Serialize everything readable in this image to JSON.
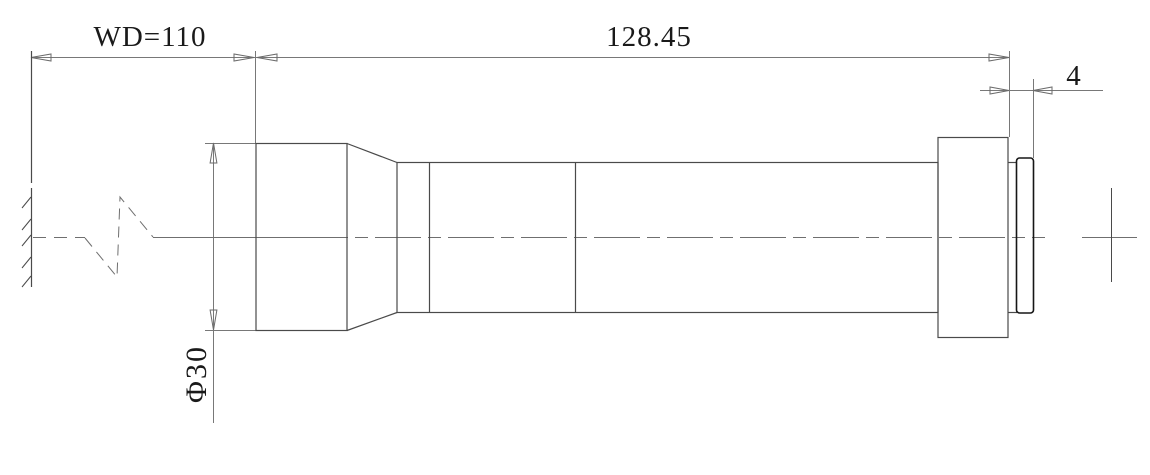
{
  "drawing": {
    "type": "technical-lens-drawing",
    "background": "#ffffff",
    "colors": {
      "object_line": "#4a4a4a",
      "dimension_line": "#787878",
      "centerline": "#6f6f6f",
      "ring_line": "#161616",
      "text": "#1a1a1a"
    },
    "dimensions": {
      "working_distance": {
        "label": "WD=110",
        "value": 110
      },
      "barrel_length": {
        "label": "128.45",
        "value": 128.45
      },
      "back_offset": {
        "label": "4",
        "value": 4
      },
      "front_diameter": {
        "label": "Φ30",
        "value": 30
      }
    },
    "parts": [
      "object-plane-wall",
      "optical-axis-break",
      "optical-axis-centerline",
      "lens-front-block",
      "lens-taper",
      "lens-barrel",
      "mount-flange",
      "rear-ring",
      "image-plane-cross"
    ]
  }
}
